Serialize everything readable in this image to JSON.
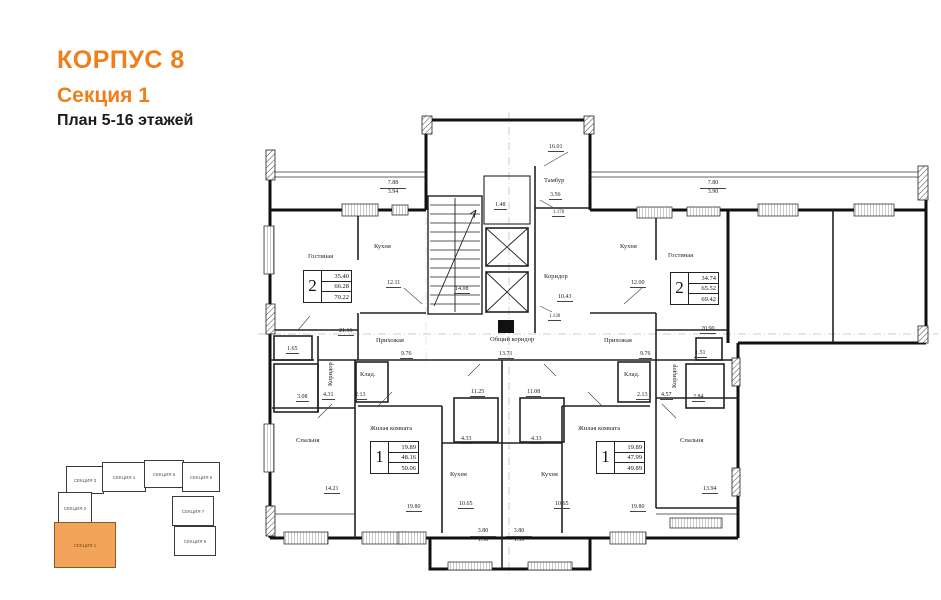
{
  "header": {
    "building": "КОРПУС 8",
    "section": "Секция 1",
    "plan_title": "План 5-16 этажей"
  },
  "colors": {
    "accent": "#EE7F1A",
    "minimap_highlight": "#F2A45A",
    "line": "#1c1c1c"
  },
  "minimap": {
    "sections": [
      {
        "label": "СЕКЦИЯ 3",
        "highlighted": false
      },
      {
        "label": "СЕКЦИЯ 4",
        "highlighted": false
      },
      {
        "label": "СЕКЦИЯ 5",
        "highlighted": false
      },
      {
        "label": "СЕКЦИЯ 6",
        "highlighted": false
      },
      {
        "label": "СЕКЦИЯ 2",
        "highlighted": false
      },
      {
        "label": "СЕКЦИЯ 7",
        "highlighted": false
      },
      {
        "label": "СЕКЦИЯ 1",
        "highlighted": true
      },
      {
        "label": "СЕКЦИЯ 8",
        "highlighted": false
      }
    ]
  },
  "plan": {
    "stamps": {
      "apt2_left": {
        "rooms": "2",
        "living_area": "35.40",
        "area": "66.28",
        "total_area": "70.22"
      },
      "apt2_right": {
        "rooms": "2",
        "living_area": "34.74",
        "area": "65.52",
        "total_area": "69.42"
      },
      "apt1_left": {
        "rooms": "1",
        "living_area": "19.89",
        "area": "48.16",
        "total_area": "50.06"
      },
      "apt1_right": {
        "rooms": "1",
        "living_area": "19.89",
        "area": "47.99",
        "total_area": "49.89"
      }
    },
    "rooms": {
      "living_left": "Гостиная",
      "living_left_area": "21.16",
      "kitchen_left": "Кухня",
      "kitchen_left_area": "12.11",
      "living_right": "Гостиная",
      "living_right_area": "20.90",
      "kitchen_right": "Кухня",
      "kitchen_right_area": "12.00",
      "tambur": "Тамбур",
      "tambur_area": "3.56",
      "corridor_center": "Коридор",
      "corridor_center_area": "10.43",
      "common_corridor": "Общий коридор",
      "common_corridor_dim": "13.71",
      "stairs_area": "14.08",
      "elevator_hall_area": "1.48",
      "hall_left": "Прихожая",
      "hall_left_area": "9.76",
      "hall_right": "Прихожая",
      "hall_right_area": "9.76",
      "wc_left_area": "1.65",
      "bath_left_area": "3.08",
      "corridor_left": "Коридор",
      "corridor_left_area": "4.31",
      "closet_left": "Клад.",
      "closet_left_area": "2.13",
      "bedroom_left": "Спальня",
      "bedroom_left_area": "14.21",
      "room1_left": "Жилая комната",
      "kitchen1_left": "Кухня",
      "kitchen1_left_dim": "10.65",
      "bath1_left_area": "4.33",
      "hall1_left_area": "11.25",
      "room1_right": "Жилая комната",
      "kitchen1_right": "Кухня",
      "kitchen1_right_dim": "10.65",
      "bath1_right_area": "4.33",
      "hall1_right_area": "11.08",
      "closet_right": "Клад.",
      "closet_right_area": "2.13",
      "corridor_right": "Коридор",
      "corridor_right_area": "4.57",
      "wc_right_area": "1.51",
      "bath_right_area": "2.84",
      "bedroom_right": "Спальня",
      "bedroom_right_area": "13.94"
    },
    "dims": {
      "top_left_a": "7.88",
      "top_left_b": "3.94",
      "top_right_a": "7.80",
      "top_right_b": "3.90",
      "top_center": "16.01",
      "door_center_a": "1.170",
      "door_center_b": "1.130",
      "bottom_left": "19.80",
      "bottom_right": "19.80",
      "porch_left_a": "3.80",
      "porch_left_b": "1.90",
      "porch_right_a": "3.80",
      "porch_right_b": "1.90"
    }
  }
}
